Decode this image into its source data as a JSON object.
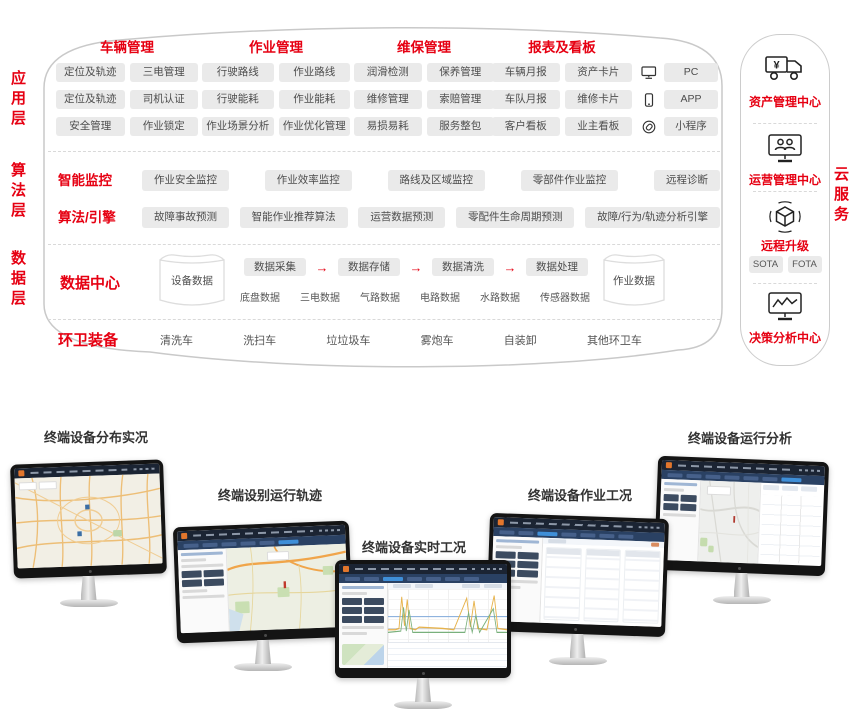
{
  "colors": {
    "accent_red": "#e60012",
    "pill_bg": "#eaeaea",
    "screen_header": "#1b2433",
    "logo_orange": "#e2762c"
  },
  "arch": {
    "layers": [
      {
        "label": "应用层"
      },
      {
        "label": "算法层"
      },
      {
        "label": "数据层"
      }
    ],
    "app": {
      "groups": [
        {
          "title": "车辆管理",
          "rows": [
            [
              "定位及轨迹",
              "三电管理"
            ],
            [
              "定位及轨迹",
              "司机认证"
            ],
            [
              "安全管理",
              "作业锁定"
            ]
          ]
        },
        {
          "title": "作业管理",
          "rows": [
            [
              "行驶路线",
              "作业路线"
            ],
            [
              "行驶能耗",
              "作业能耗"
            ],
            [
              "作业场景分析",
              "作业优化管理"
            ]
          ]
        },
        {
          "title": "维保管理",
          "rows": [
            [
              "润滑检测",
              "保养管理"
            ],
            [
              "维修管理",
              "索赔管理"
            ],
            [
              "易损易耗",
              "服务整包"
            ]
          ]
        },
        {
          "title": "报表及看板",
          "rows": [
            [
              "车辆月报",
              "资产卡片"
            ],
            [
              "车队月报",
              "维修卡片"
            ],
            [
              "客户看板",
              "业主看板"
            ]
          ]
        }
      ],
      "platforms": [
        {
          "icon": "pc-icon",
          "label": "PC"
        },
        {
          "icon": "app-icon",
          "label": "APP"
        },
        {
          "icon": "miniprogram-icon",
          "label": "小程序"
        }
      ]
    },
    "algo": {
      "rows": [
        {
          "label": "智能监控",
          "items": [
            "作业安全监控",
            "作业效率监控",
            "路线及区域监控",
            "零部件作业监控",
            "远程诊断"
          ]
        },
        {
          "label": "算法/引擎",
          "items": [
            "故障事故预测",
            "智能作业推荐算法",
            "运营数据预测",
            "零配件生命周期预测",
            "故障/行为/轨迹分析引擎"
          ]
        }
      ]
    },
    "data": {
      "label": "数据中心",
      "left_db": "设备数据",
      "pipeline": [
        "数据采集",
        "数据存储",
        "数据清洗",
        "数据处理"
      ],
      "sources": [
        "底盘数据",
        "三电数据",
        "气路数据",
        "电路数据",
        "水路数据",
        "传感器数据"
      ],
      "right_db": "作业数据"
    },
    "equipment": {
      "label": "环卫装备",
      "items": [
        "清洗车",
        "洗扫车",
        "垃垃圾车",
        "雾炮车",
        "自装卸",
        "其他环卫车"
      ]
    }
  },
  "cloud": {
    "side_label": "云服务",
    "sections": [
      {
        "icon": "truck-yen-icon",
        "label": "资产管理中心"
      },
      {
        "icon": "monitor-users-icon",
        "label": "运营管理中心"
      },
      {
        "icon": "cube-icon",
        "label": "远程升级",
        "tags": [
          "SOTA",
          "FOTA"
        ]
      },
      {
        "icon": "monitor-chart-icon",
        "label": "决策分析中心"
      }
    ]
  },
  "monitors": [
    {
      "title": "终端设备分布实况"
    },
    {
      "title": "终端设别运行轨迹"
    },
    {
      "title": "终端设备实时工况"
    },
    {
      "title": "终端设备作业工况"
    },
    {
      "title": "终端设备运行分析"
    }
  ]
}
